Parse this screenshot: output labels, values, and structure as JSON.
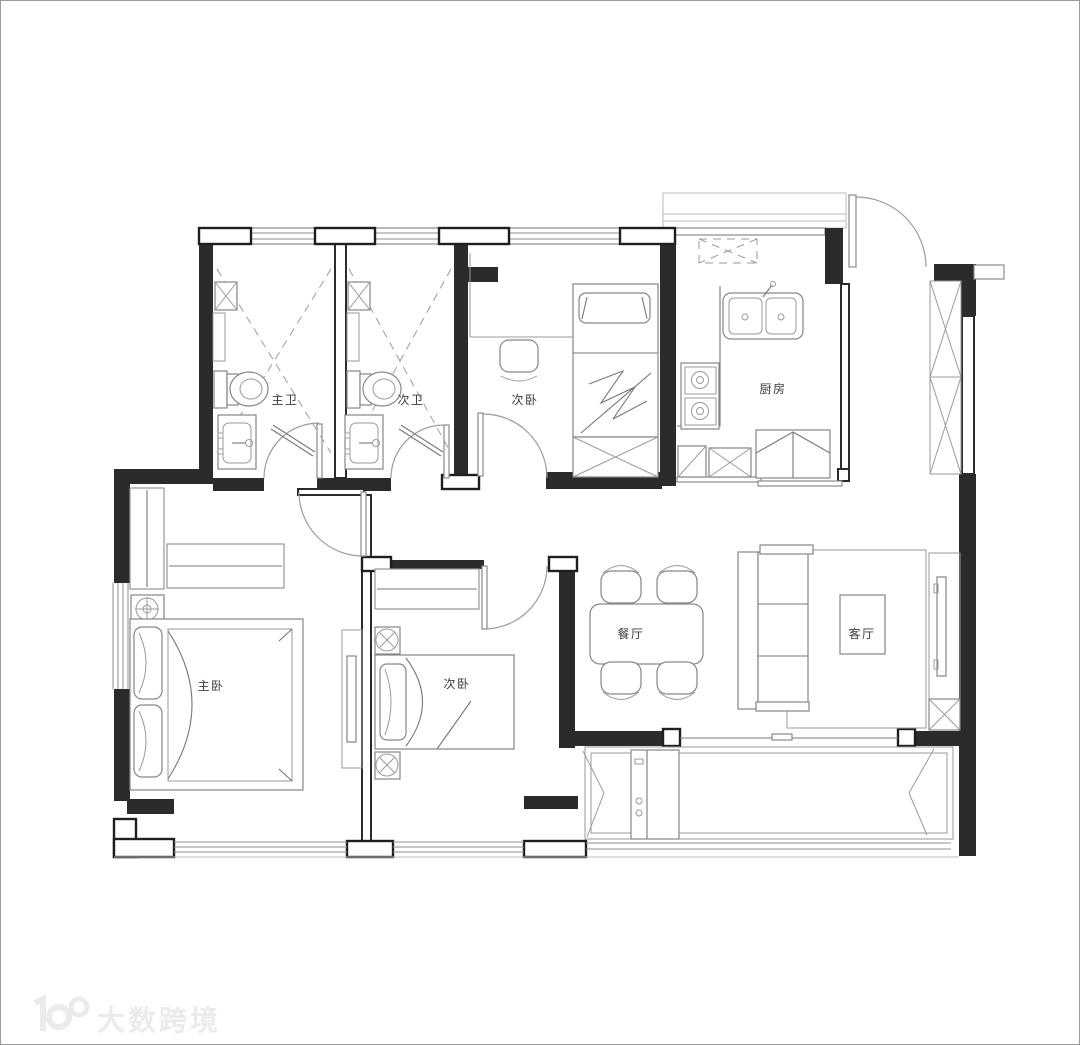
{
  "plan": {
    "type": "apartment-floor-plan",
    "rooms": {
      "master_bath": {
        "label": "主卫"
      },
      "second_bath": {
        "label": "次卫"
      },
      "bedroom_top": {
        "label": "次卧"
      },
      "kitchen": {
        "label": "厨房"
      },
      "master_bedroom": {
        "label": "主卧"
      },
      "bedroom_bottom": {
        "label": "次卧"
      },
      "dining": {
        "label": "餐厅"
      },
      "living": {
        "label": "客厅"
      }
    }
  },
  "watermark": {
    "logo": "100",
    "text": "大数跨境"
  },
  "colors": {
    "wall": "#2b2b2b",
    "furniture_line": "#868686",
    "window_line": "#8c8c8c",
    "label_text": "#3c3c3c",
    "watermark": "#ebebeb",
    "background": "#ffffff"
  }
}
